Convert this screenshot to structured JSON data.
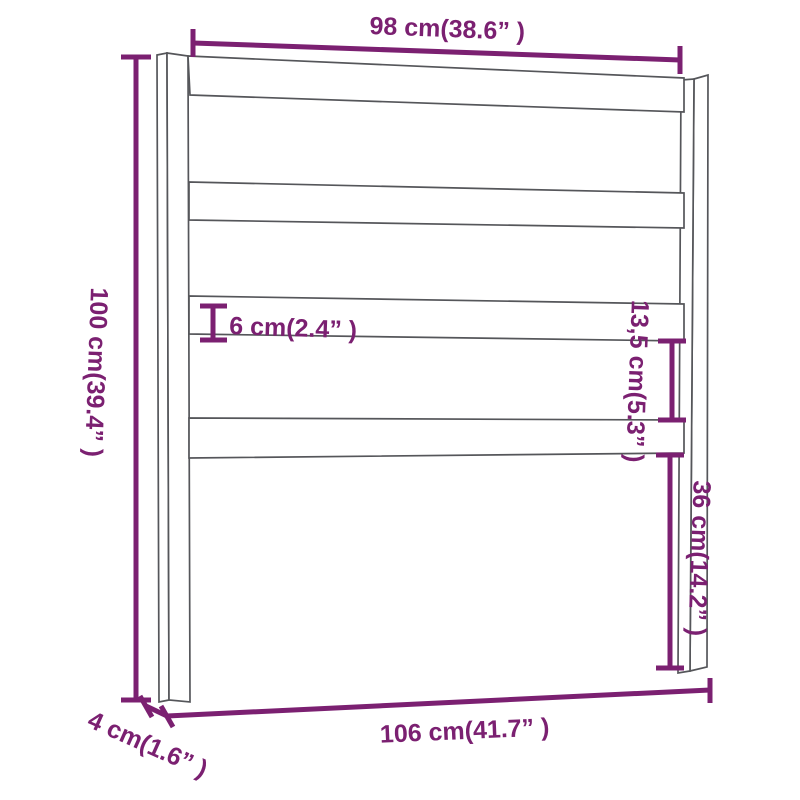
{
  "diagram": {
    "type": "product-dimension-diagram",
    "subject": "bed headboard line drawing with two posts and four horizontal slats",
    "colors": {
      "dimension_accent": "#7b2071",
      "drawing_outline": "#55565a",
      "background": "#ffffff"
    },
    "labels": {
      "top_width": "98 cm(38.6” )",
      "total_height": "100 cm(39.4” )",
      "slat_height": "6 cm(2.4” )",
      "slat_gap": "13,5 cm(5.3” )",
      "leg_clearance": "36 cm(14.2” )",
      "bottom_width": "106 cm(41.7” )",
      "post_depth": "4 cm(1.6” )"
    },
    "measurements": [
      {
        "name": "top-width",
        "cm": "98",
        "inches": "38.6"
      },
      {
        "name": "total-height",
        "cm": "100",
        "inches": "39.4"
      },
      {
        "name": "slat-height",
        "cm": "6",
        "inches": "2.4"
      },
      {
        "name": "slat-gap",
        "cm": "13,5",
        "inches": "5.3"
      },
      {
        "name": "leg-clearance",
        "cm": "36",
        "inches": "14.2"
      },
      {
        "name": "bottom-width",
        "cm": "106",
        "inches": "41.7"
      },
      {
        "name": "post-depth",
        "cm": "4",
        "inches": "1.6"
      }
    ]
  }
}
